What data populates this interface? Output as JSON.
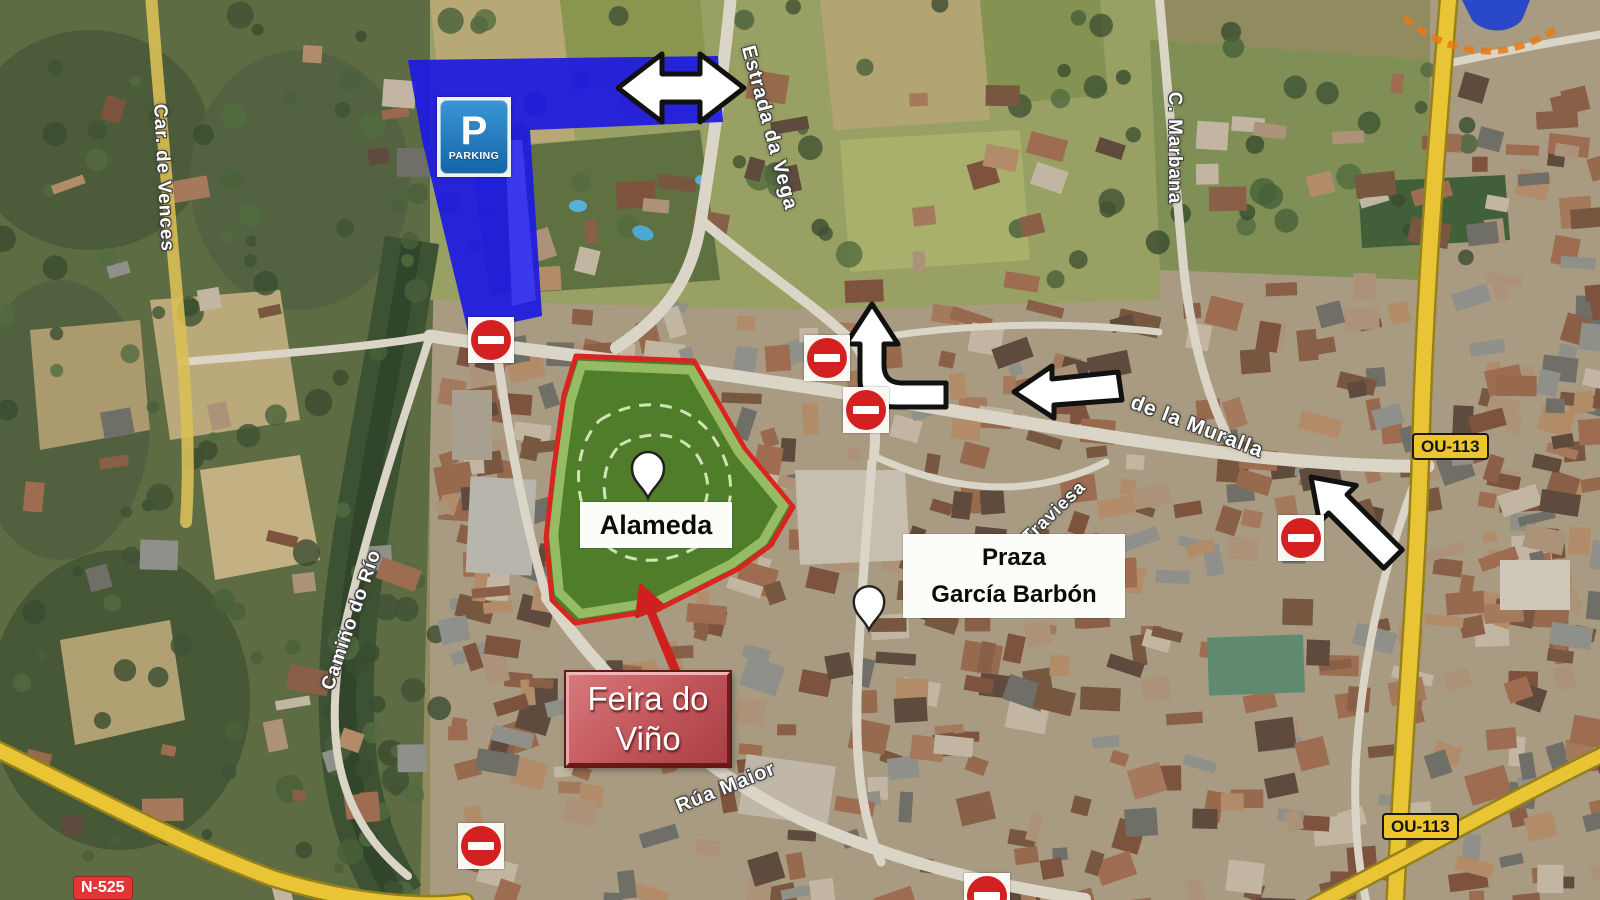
{
  "streets": {
    "estrada_da_vega": "Estrada da Vega",
    "c_marbana": "C. Marbana",
    "car_de_vences": "Car. de Vences",
    "camino_do_rio": "Camiño do Río",
    "de_la_muralla": "de la Muralla",
    "traviesa": "Traviesa",
    "rua_maior": "Rúa Maior"
  },
  "badges": {
    "ou113": "OU-113",
    "n525": "N-525"
  },
  "parking": {
    "symbol": "P",
    "label": "PARKING"
  },
  "places": {
    "alameda": "Alameda",
    "praza_line1": "Praza",
    "praza_line2": "García Barbón",
    "feira_line1": "Feira do",
    "feira_line2": "Viño"
  },
  "icons": {
    "no_entry_count": 6,
    "map_pins": [
      "alameda-pin",
      "praza-pin"
    ]
  },
  "colors": {
    "parking_zone": "#1d1ae2",
    "alameda_fill": "#4f7d2a",
    "alameda_border": "#d92420",
    "feira_box": "#c05458",
    "badge_yellow": "#ecc52f",
    "badge_red": "#e23535",
    "no_entry_red": "#d32121",
    "arrow_white": "#ffffff",
    "arrow_red": "#cf1f1f"
  }
}
